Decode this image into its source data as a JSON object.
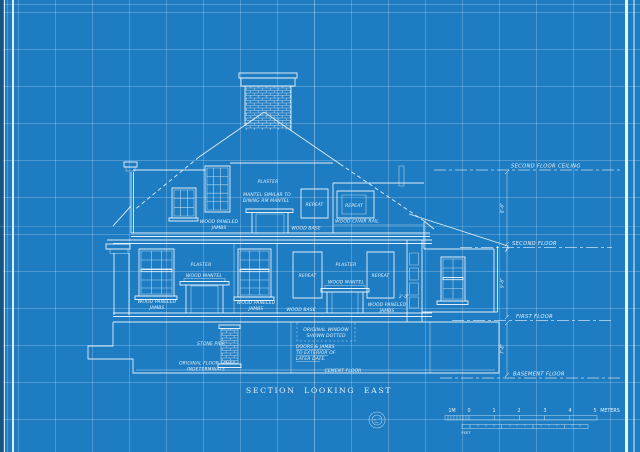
{
  "title": "SECTION LOOKING EAST",
  "colors": {
    "background": "#1d7cc2",
    "grid": "#7fb7e0",
    "line": "#f2f8fc"
  },
  "floor_labels": {
    "second_floor_ceiling": "SECOND FLOOR CEILING",
    "second_floor": "SECOND FLOOR",
    "first_floor": "FIRST FLOOR",
    "basement_floor": "BASEMENT FLOOR"
  },
  "dimensions": {
    "ceiling_to_second": "8'-6\"",
    "second_to_first": "9'-6\"",
    "first_to_basement": "7'-8\"",
    "wing_wall": "2'-0\""
  },
  "annotations": {
    "plaster": "PLASTER",
    "mantel_note_1": "MANTEL SIMILAR TO",
    "mantel_note_2": "DINING RM MANTEL",
    "repeat": "REPEAT",
    "wood_base": "WOOD BASE",
    "wood_chair_rail": "WOOD CHAIR RAIL",
    "wood_paneled": "WOOD PANELED",
    "jambs": "JAMBS",
    "wood_mantel": "WOOD MANTEL",
    "stone_pier": "STONE PIER",
    "original_window_1": "ORIGINAL WINDOW",
    "original_window_2": "SHOWN DOTTED",
    "doors_note_1": "DOORS & JAMBS",
    "doors_note_2": "TO EXTERIOR OF",
    "doors_note_3": "LATER DATE.",
    "floor_level_1": "ORIGINAL FLOOR LEVEL",
    "floor_level_2": "INDETERMINATE.",
    "cement_floor": "CEMENT FLOOR"
  },
  "scale_bar": {
    "m_minus": "1M",
    "m0": "0",
    "m1": "1",
    "m2": "2",
    "m3": "3",
    "m4": "4",
    "m5": "5",
    "meters_unit": "METERS",
    "feet_unit": "FEET"
  }
}
